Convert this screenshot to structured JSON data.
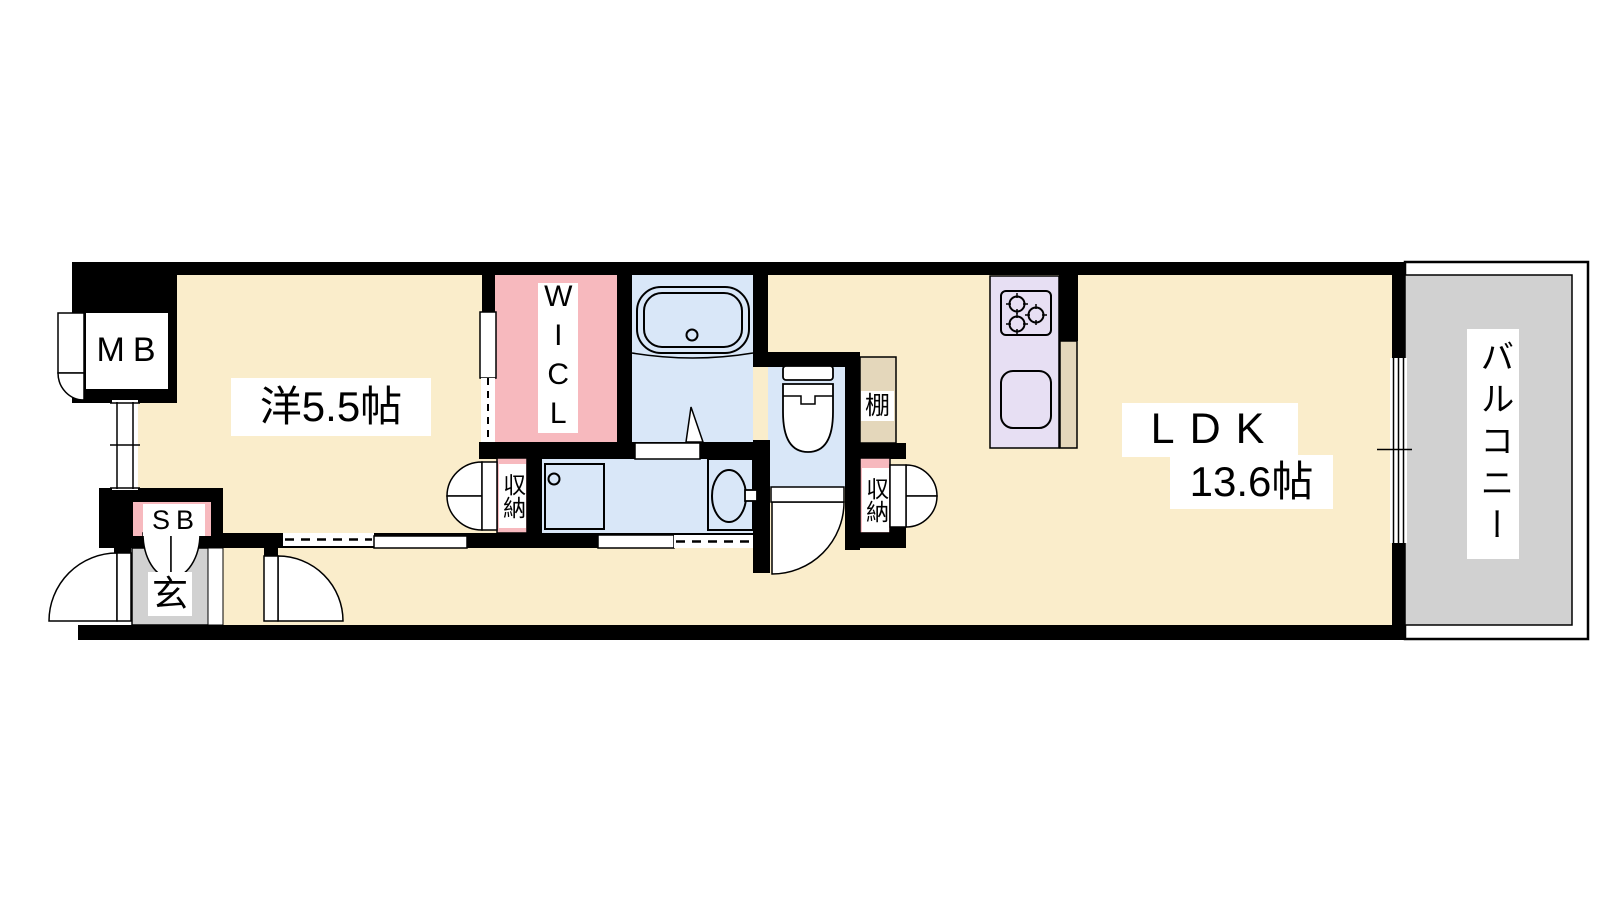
{
  "title": "1LDK apartment floor plan",
  "palette": {
    "wall": "#000000",
    "floor": "#FAEDCB",
    "pink": "#F7B9BE",
    "water": "#D9E7F8",
    "tan": "#E4D7BB",
    "balcony_gray": "#D1D1D1",
    "entry_gray": "#D1D1D1",
    "kitchen": "#E7DFF3",
    "label_bg": "#FFFFFF",
    "line": "#000000"
  },
  "labels": {
    "bedroom": "洋5.5帖",
    "wicl": "WICL",
    "ldk_line1": "LDK",
    "ldk_line2": "13.6帖",
    "balcony": "バルコニー",
    "meter_box": "MB",
    "shoe_box": "SB",
    "entrance": "玄",
    "shelf": "棚",
    "storage_hall": "収納",
    "storage_ldk": "収納"
  },
  "rooms": [
    {
      "name": "western-room",
      "label": "洋5.5帖",
      "size_jo": 5.5
    },
    {
      "name": "ldk",
      "label": "LDK 13.6帖",
      "size_jo": 13.6
    },
    {
      "name": "walk-in-closet",
      "label": "WICL"
    },
    {
      "name": "balcony",
      "label": "バルコニー"
    },
    {
      "name": "entrance",
      "label": "玄"
    },
    {
      "name": "meter-box",
      "label": "MB"
    },
    {
      "name": "shoe-box",
      "label": "SB"
    },
    {
      "name": "shelf",
      "label": "棚"
    },
    {
      "name": "storage-hall",
      "label": "収納"
    },
    {
      "name": "storage-ldk",
      "label": "収納"
    }
  ]
}
